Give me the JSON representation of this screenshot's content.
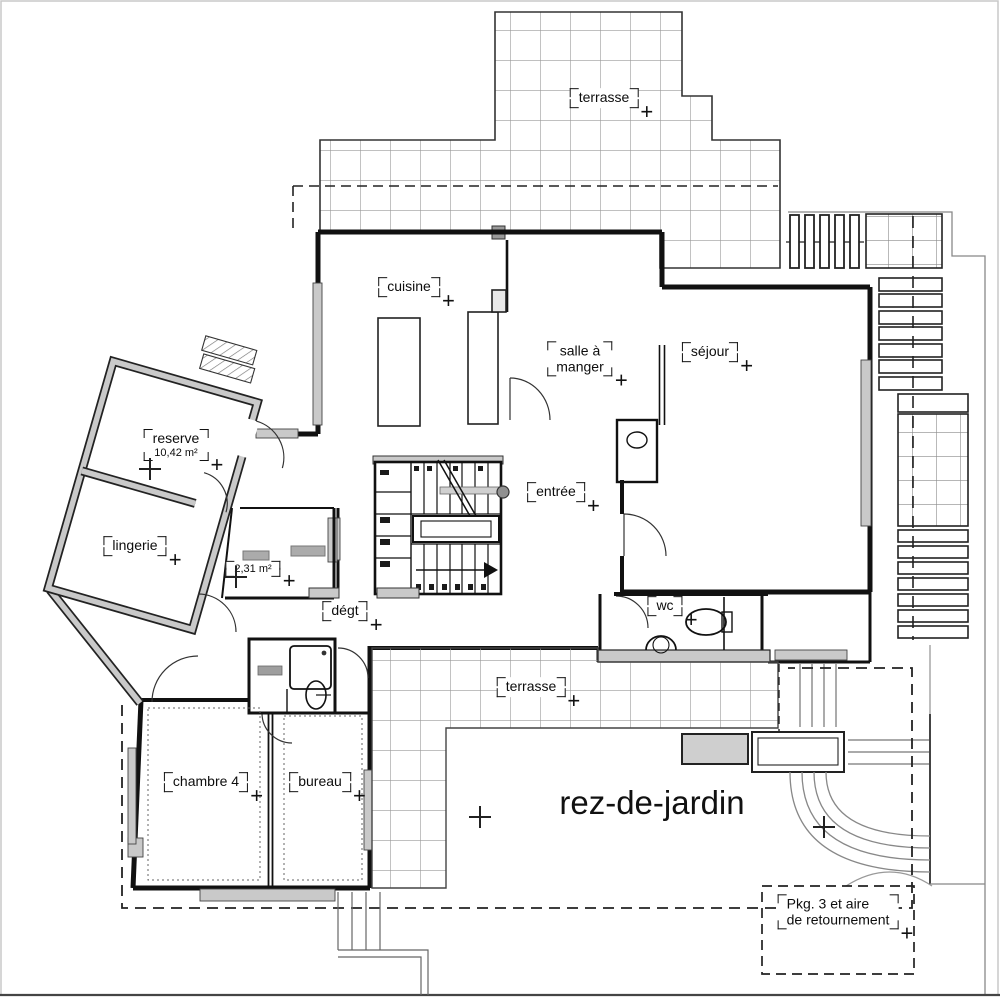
{
  "floor_caption": {
    "text": "rez-de-jardin"
  },
  "labels": [
    {
      "id": "terrasse-top",
      "x": 604,
      "y": 98,
      "lines": [
        {
          "text": "terrasse",
          "size": 14
        }
      ]
    },
    {
      "id": "cuisine",
      "x": 409,
      "y": 287,
      "lines": [
        {
          "text": "cuisine",
          "size": 14
        }
      ]
    },
    {
      "id": "salle-a-manger",
      "x": 580,
      "y": 359,
      "lines": [
        {
          "text": "salle à",
          "size": 14
        },
        {
          "text": "manger",
          "size": 14
        }
      ]
    },
    {
      "id": "sejour",
      "x": 710,
      "y": 352,
      "lines": [
        {
          "text": "séjour",
          "size": 14
        }
      ]
    },
    {
      "id": "reserve",
      "x": 176,
      "y": 445,
      "lines": [
        {
          "text": "reserve",
          "size": 14
        },
        {
          "text": "10,42 m²",
          "size": 11
        }
      ]
    },
    {
      "id": "entree",
      "x": 556,
      "y": 492,
      "lines": [
        {
          "text": "entrée",
          "size": 14
        }
      ]
    },
    {
      "id": "lingerie",
      "x": 135,
      "y": 546,
      "lines": [
        {
          "text": "lingerie",
          "size": 14
        }
      ]
    },
    {
      "id": "closet-area",
      "x": 253,
      "y": 569,
      "lines": [
        {
          "text": "2,31 m²",
          "size": 11
        }
      ]
    },
    {
      "id": "degt",
      "x": 345,
      "y": 611,
      "lines": [
        {
          "text": "dégt",
          "size": 14
        }
      ]
    },
    {
      "id": "wc",
      "x": 665,
      "y": 606,
      "lines": [
        {
          "text": "wc",
          "size": 14
        }
      ]
    },
    {
      "id": "terrasse-bottom",
      "x": 531,
      "y": 687,
      "lines": [
        {
          "text": "terrasse",
          "size": 14
        }
      ]
    },
    {
      "id": "chambre-4",
      "x": 206,
      "y": 782,
      "lines": [
        {
          "text": "chambre 4",
          "size": 14
        }
      ]
    },
    {
      "id": "bureau",
      "x": 320,
      "y": 782,
      "lines": [
        {
          "text": "bureau",
          "size": 14
        }
      ]
    },
    {
      "id": "parking",
      "x": 838,
      "y": 912,
      "align": "left",
      "lines": [
        {
          "text": "Pkg. 3 et aire",
          "size": 14
        },
        {
          "text": "de retournement",
          "size": 14
        }
      ]
    }
  ],
  "survey_marks": [
    {
      "x": 824,
      "y": 827
    },
    {
      "x": 480,
      "y": 817
    },
    {
      "x": 150,
      "y": 469
    },
    {
      "x": 236,
      "y": 577
    }
  ],
  "colors": {
    "wall": "#111111",
    "poche": "#c9c9c9",
    "grid": "#9a9a9a",
    "site_line": "#888888",
    "background": "#ffffff"
  }
}
